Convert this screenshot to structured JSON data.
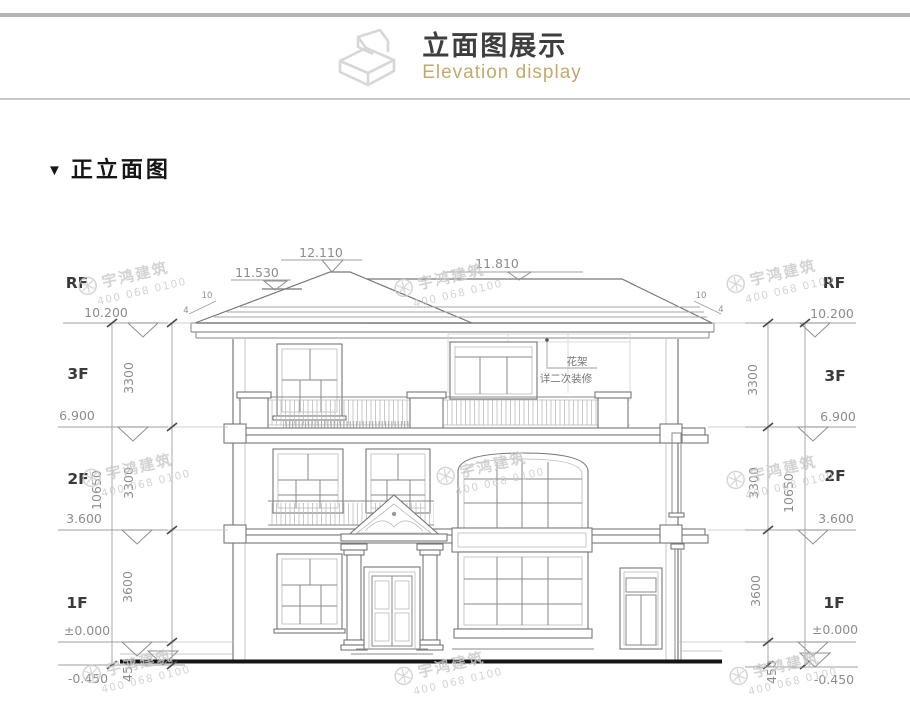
{
  "header": {
    "title": "立面图展示",
    "subtitle": "Elevation display"
  },
  "section": {
    "marker": "▼",
    "title": "正立面图"
  },
  "watermark": {
    "brand": "宇鸿建筑",
    "phone": "400 068 0100"
  },
  "drawing": {
    "floor_labels": [
      "RF",
      "3F",
      "2F",
      "1F"
    ],
    "elevation_marks": [
      "10.200",
      "6.900",
      "3.600",
      "±0.000",
      "-0.450"
    ],
    "top_marks": [
      "11.530",
      "12.110",
      "11.810"
    ],
    "dim_segments": [
      "3300",
      "3300",
      "3600",
      "450"
    ],
    "dim_total": "10650",
    "slope": {
      "rise": "10",
      "run": "4"
    },
    "note": {
      "line1": "花架",
      "line2": "详二次装修"
    },
    "colors": {
      "subtitle_accent": "#c3aa6b",
      "linework": "#8a8a8a",
      "ground": "#151515",
      "watermark": "#c9c9c9"
    }
  }
}
